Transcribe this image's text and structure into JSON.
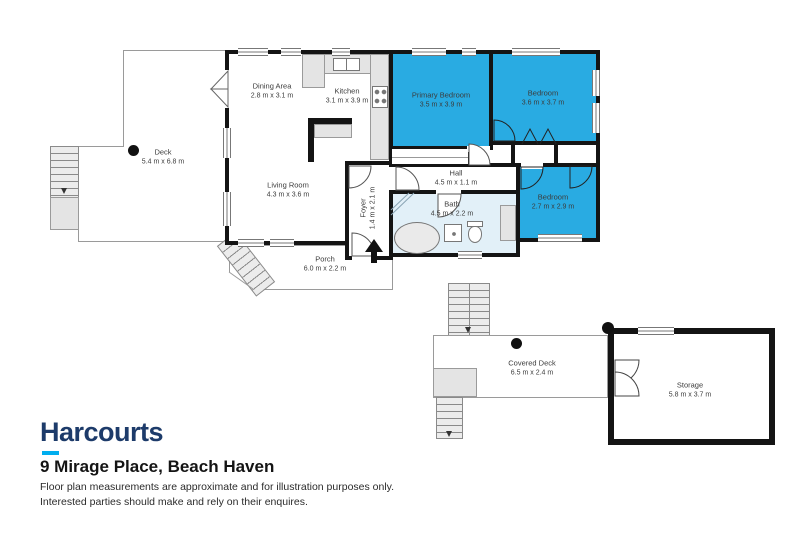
{
  "rooms": {
    "deck": {
      "name": "Deck",
      "dims": "5.4 m x 6.8 m"
    },
    "dining": {
      "name": "Dining Area",
      "dims": "2.8 m x 3.1 m"
    },
    "kitchen": {
      "name": "Kitchen",
      "dims": "3.1 m x 3.9 m"
    },
    "primary_bedroom": {
      "name": "Primary Bedroom",
      "dims": "3.5 m x 3.9 m"
    },
    "bedroom2": {
      "name": "Bedroom",
      "dims": "3.6 m x 3.7 m"
    },
    "living": {
      "name": "Living Room",
      "dims": "4.3 m x 3.6 m"
    },
    "hall": {
      "name": "Hall",
      "dims": "4.5 m x 1.1 m"
    },
    "foyer": {
      "name": "Foyer",
      "dims": "1.4 m x 2.1 m"
    },
    "bath": {
      "name": "Bath",
      "dims": "4.5 m x 2.2 m"
    },
    "bedroom3": {
      "name": "Bedroom",
      "dims": "2.7 m x 2.9 m"
    },
    "porch": {
      "name": "Porch",
      "dims": "6.0 m x 2.2 m"
    },
    "covered_deck": {
      "name": "Covered Deck",
      "dims": "6.5 m x 2.4 m"
    },
    "storage": {
      "name": "Storage",
      "dims": "5.8 m x 3.7 m"
    }
  },
  "footer": {
    "brand": "Harcourts",
    "address": "9 Mirage Place, Beach Haven",
    "disclaimer_line1": "Floor plan measurements are approximate and for illustration purposes only.",
    "disclaimer_line2": "Interested parties should make and rely on their enquires."
  },
  "colors": {
    "bedroom_fill": "#29abe2",
    "bath_fill": "#e2f0f8",
    "wall": "#141414",
    "brand_navy": "#1d3b6a",
    "brand_cyan": "#00aeef"
  }
}
